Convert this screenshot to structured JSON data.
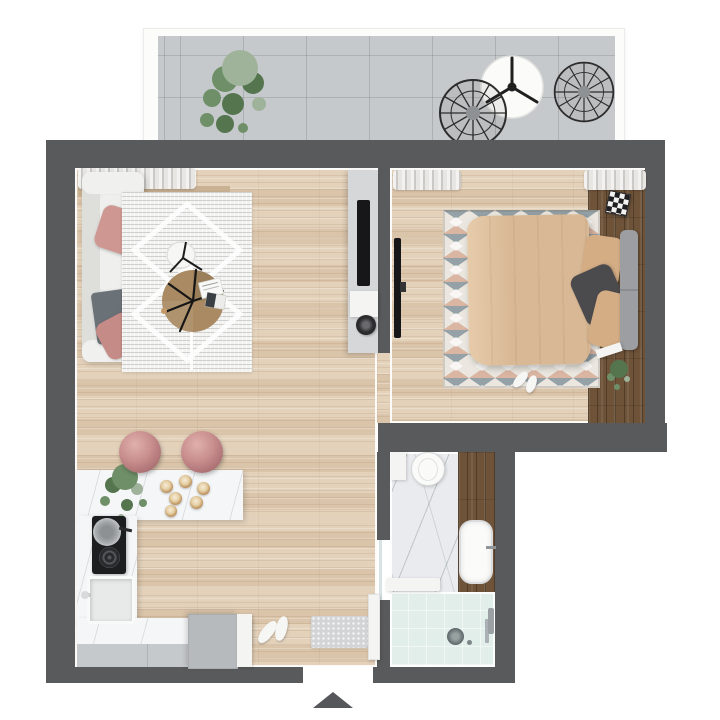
{
  "scene": {
    "type": "apartment-floor-plan-top-view",
    "entrance_marker": "arrow-up-triangle"
  },
  "palette": {
    "exterior": "#ffffff",
    "wall": "#595a5c",
    "wood": "#dcc8af",
    "walnut": "#6e5339",
    "concrete": "#c6c9cb",
    "marble": "#e9ebee",
    "counter": "#f5f6f7",
    "cabinet": "#c6c9cc",
    "wardrobe": "#b7babd",
    "sofa": "#eaeae8",
    "sofa_back": "#dededb",
    "pillow_pink": "#cf9792",
    "pillow_pink2": "#c58b86",
    "throw_gray": "#6a7177",
    "rug_living": "#f2f2f0",
    "table_wood": "#a98a62",
    "tv_black": "#17171a",
    "duvet": "#d9b995",
    "duvet_hi": "#e6cbab",
    "pillow_beige": "#d4ad85",
    "pillow_dark": "#4b4b4e",
    "headboard": "#9c9ea1",
    "rug_bed": "#ebe7e0",
    "rug_slate": "#7e8f99",
    "rug_rust": "#cf9478",
    "mint": "#e2eee9",
    "gold": "#c39a66",
    "stool": "#c78d8d",
    "stool_dark": "#a96f72",
    "plant": "#6f8f68",
    "plant_dark": "#55754f",
    "plant_gray": "#9fb39b",
    "curtain": "#e8e6e3",
    "doormat": "#d2d4d5",
    "arrow": "#55575a",
    "steel": "#9aa0a3",
    "sill_tan": "#c9b193",
    "console_gray": "#d5d7d8"
  },
  "inventory": {
    "balcony": [
      "potted-plant",
      "round-table",
      "wire-chair",
      "wire-chair"
    ],
    "living_room": [
      "window-curtain",
      "window-sill",
      "sofa",
      "pink-pillow",
      "pink-pillow",
      "throw-blanket",
      "area-rug",
      "side-chair",
      "coffee-table",
      "magazines",
      "floor-lamp",
      "tv-console",
      "tv",
      "speaker"
    ],
    "kitchen": [
      "island-counter",
      "potted-plant",
      "pendant-lights",
      "bar-stool",
      "bar-stool",
      "cooktop",
      "pan",
      "sink",
      "faucet",
      "base-counter",
      "base-cabinets",
      "wardrobe"
    ],
    "entry": [
      "doormat",
      "shoes",
      "entrance-arrow"
    ],
    "bedroom": [
      "window-curtain",
      "window-curtain",
      "double-bed",
      "duvet",
      "pillow",
      "pillow",
      "pillow",
      "headboard",
      "kilim-rug",
      "wall-tv",
      "storage-box",
      "book",
      "potted-plant",
      "slippers"
    ],
    "bathroom": [
      "toilet",
      "wall-shelf",
      "vanity",
      "washbasin",
      "faucet",
      "shower",
      "shower-drain",
      "shower-fixture",
      "bath-shelf",
      "door-leaf",
      "glass-panel"
    ]
  }
}
